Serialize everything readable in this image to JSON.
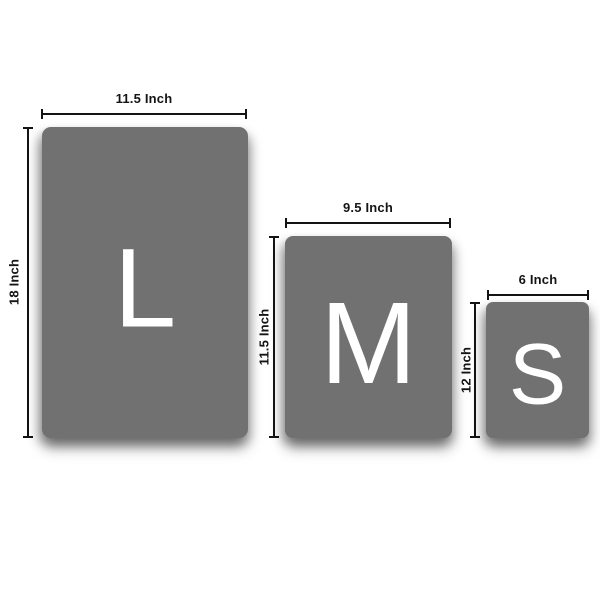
{
  "colors": {
    "background": "#ffffff",
    "panel": "#717171",
    "letter": "#ffffff",
    "dimension": "#141414"
  },
  "sizes": [
    {
      "name": "large",
      "letter": "L",
      "width_label": "11.5 Inch",
      "height_label": "18 Inch"
    },
    {
      "name": "medium",
      "letter": "M",
      "width_label": "9.5 Inch",
      "height_label": "11.5 Inch"
    },
    {
      "name": "small",
      "letter": "S",
      "width_label": "6 Inch",
      "height_label": "12 Inch"
    }
  ]
}
